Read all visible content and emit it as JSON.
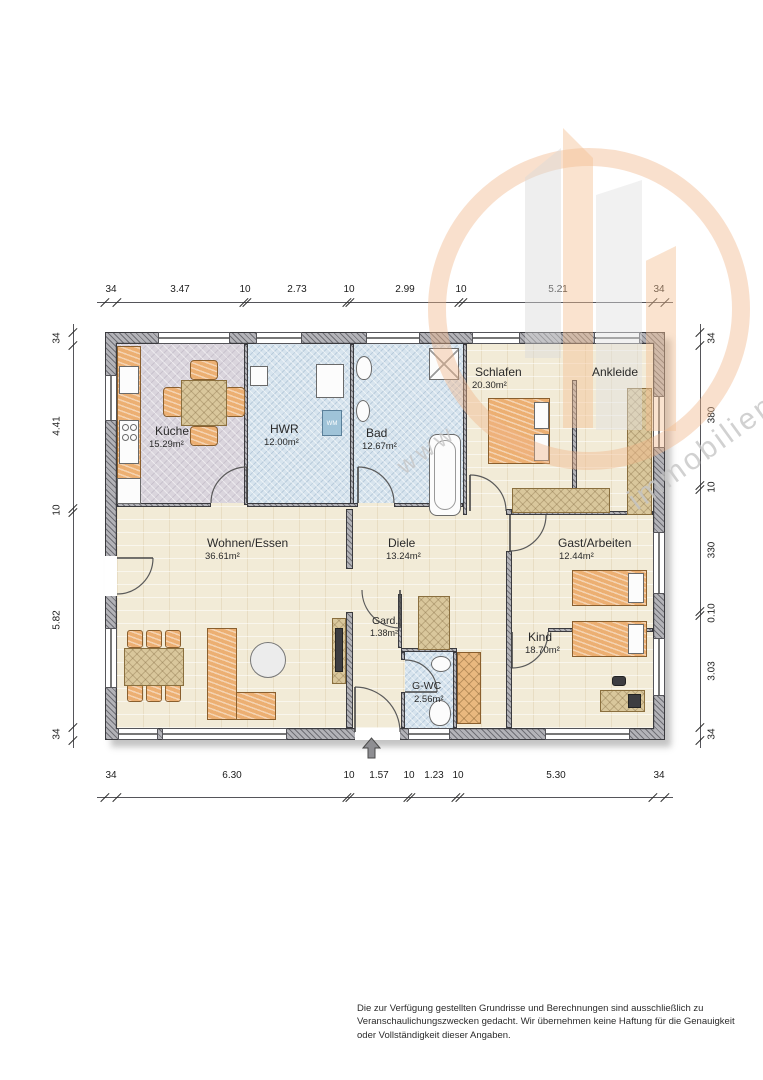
{
  "rooms": {
    "kueche": {
      "name": "Küche",
      "area": "15.29m²"
    },
    "hwr": {
      "name": "HWR",
      "area": "12.00m²",
      "appliance": "WM"
    },
    "bad": {
      "name": "Bad",
      "area": "12.67m²"
    },
    "schlafen": {
      "name": "Schlafen",
      "area": "20.30m²"
    },
    "ankleide": {
      "name": "Ankleide"
    },
    "wohnen": {
      "name": "Wohnen/Essen",
      "area": "36.61m²"
    },
    "diele": {
      "name": "Diele",
      "area": "13.24m²"
    },
    "gast": {
      "name": "Gast/Arbeiten",
      "area": "12.44m²"
    },
    "kind": {
      "name": "Kind",
      "area": "18.70m²"
    },
    "gard": {
      "name": "Gard.",
      "area": "1.38m²"
    },
    "gwc": {
      "name": "G-WC",
      "area": "2.56m²"
    }
  },
  "dimensions": {
    "top": [
      "34",
      "3.47",
      "10",
      "2.73",
      "10",
      "2.99",
      "10",
      "5.21",
      "34"
    ],
    "bottom": [
      "34",
      "6.30",
      "10",
      "1.57",
      "10",
      "1.23",
      "10",
      "5.30",
      "34"
    ],
    "left": [
      "34",
      "4.41",
      "10",
      "5.82",
      "34"
    ],
    "right": [
      "34",
      "380",
      "10",
      "330",
      "0.10",
      "3.03",
      "34"
    ]
  },
  "watermark": {
    "fragment_www": "www",
    "fragment_immobilien": "immobilien"
  },
  "disclaimer": "Die zur Verfügung gestellten Grundrisse und Berechnungen sind ausschließlich zu Veranschaulichungszwecken gedacht. Wir übernehmen keine Haftung für die Genauigkeit oder Vollständigkeit dieser Angaben.",
  "colors": {
    "furniture_orange": "#ecaf72",
    "floor_beige": "#f2ebd7",
    "floor_blue": "#d7e4ee",
    "floor_kueche": "#dad5dd",
    "watermark_orange": "#f0b488",
    "watermark_gray": "#dcdcdc"
  }
}
